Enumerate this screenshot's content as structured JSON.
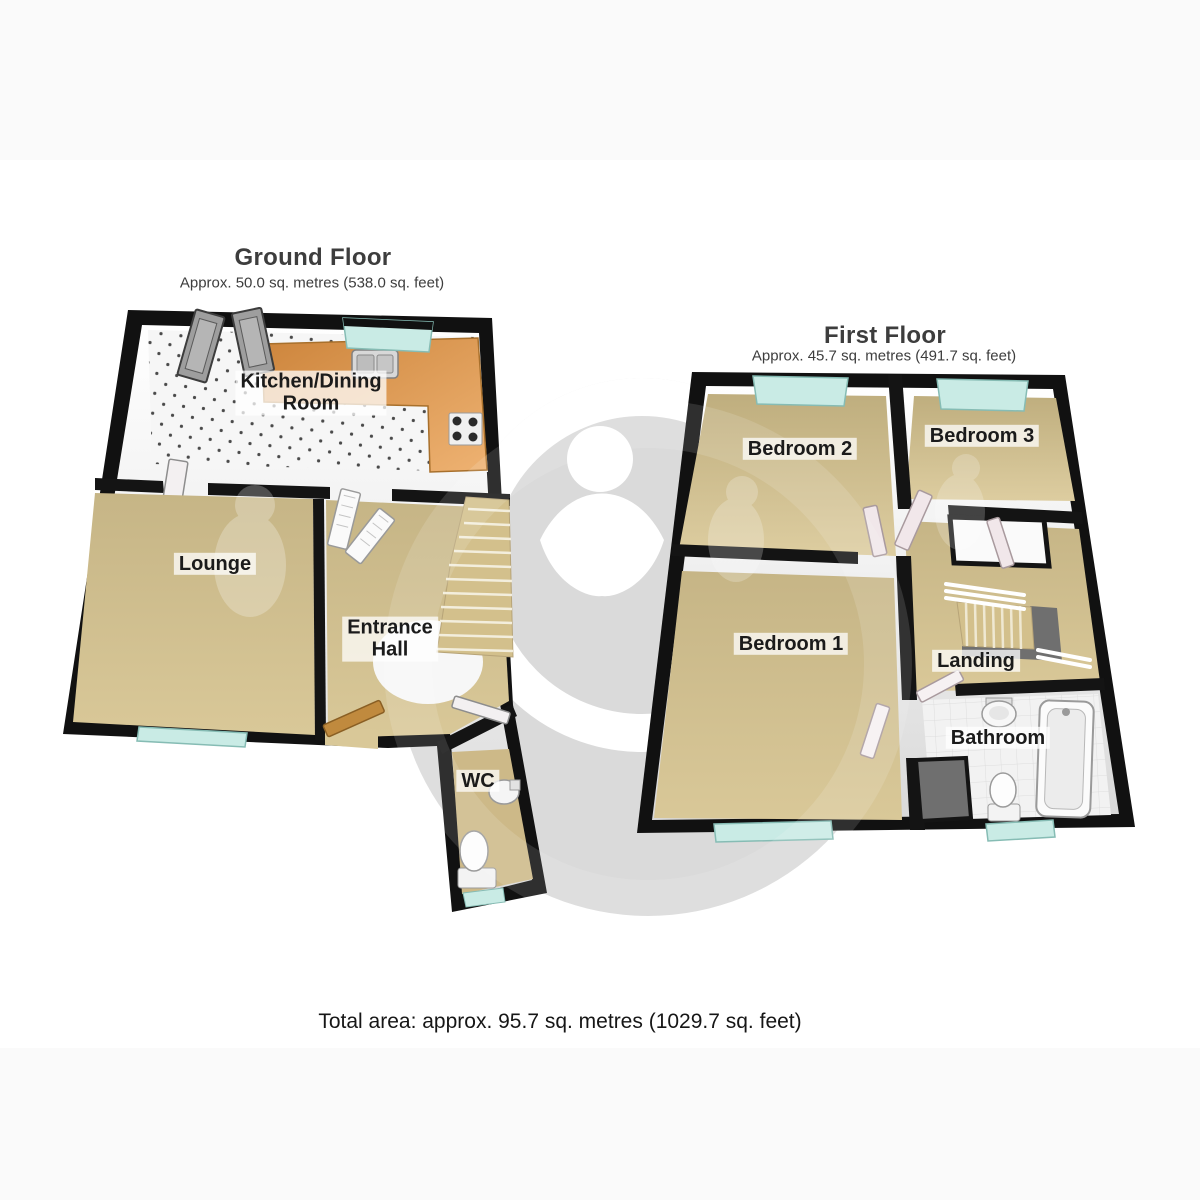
{
  "ground_floor": {
    "title": "Ground Floor",
    "subtitle": "Approx. 50.0 sq. metres (538.0 sq. feet)",
    "rooms": {
      "kitchen": {
        "label": "Kitchen/Dining\nRoom"
      },
      "lounge": {
        "label": "Lounge"
      },
      "entrance_hall": {
        "label": "Entrance\nHall"
      },
      "wc": {
        "label": "WC"
      }
    }
  },
  "first_floor": {
    "title": "First Floor",
    "subtitle": "Approx. 45.7 sq. metres (491.7 sq. feet)",
    "rooms": {
      "bedroom2": {
        "label": "Bedroom 2"
      },
      "bedroom3": {
        "label": "Bedroom 3"
      },
      "bedroom1": {
        "label": "Bedroom 1"
      },
      "landing": {
        "label": "Landing"
      },
      "bathroom": {
        "label": "Bathroom"
      }
    }
  },
  "summary": {
    "total_area": "Total area: approx. 95.7 sq. metres (1029.7 sq. feet)"
  },
  "colors": {
    "wall": "#111111",
    "carpet": "#d6c493",
    "kitchen_floor": "#f5f5f5",
    "counter_wood": "#e09a4e",
    "window_glass": "#c9ebe5",
    "watermark_grey": "#dadada",
    "stair_tread": "#d3c08c",
    "stairwell_grey": "#6f6f6f",
    "front_door_wood": "#c08a3e",
    "door_leaf_white": "#f3f0f1",
    "label_text": "#1b1b1b"
  }
}
